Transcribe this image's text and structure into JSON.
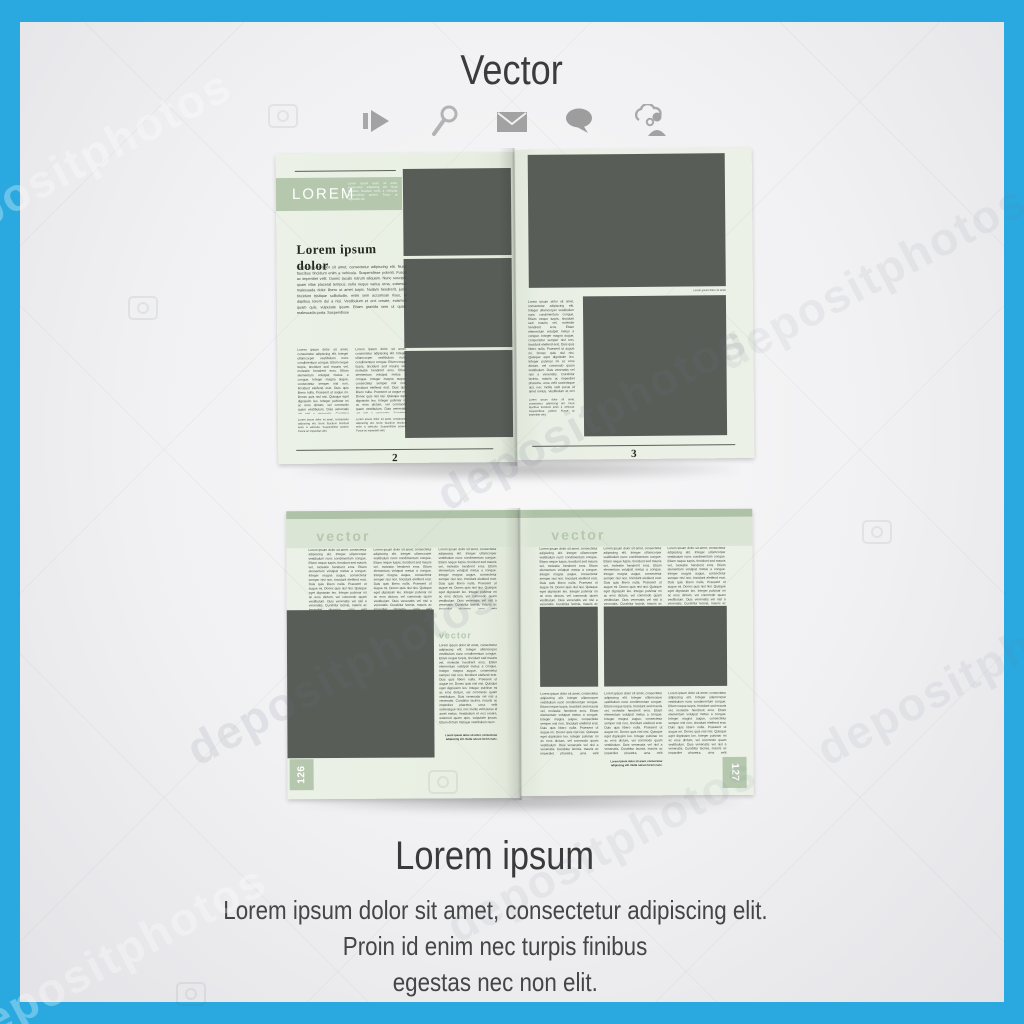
{
  "watermark": {
    "text": "depositphotos"
  },
  "header": {
    "title": "Vector",
    "icons": [
      "play-icon",
      "search-icon",
      "mail-icon",
      "chat-icon",
      "cloud-user-icon"
    ]
  },
  "lorem": {
    "body": "Lorem ipsum dolor sit amet, consectetur adipiscing elit. Integer ullamcorper vestibulum nunc condimentum congue. Etiam neque turpis, tincidunt sed mauris vel, molestie hendrerit eros. Etiam elementum volutpat metus a congue. Integer magna augue, consectetur semper nisl non, tincidunt eleifend erat. Duis quis libero nulla. Praesent ut augue mi. Donec quis nisl nisi. Quisque eget dignissim leo. Integer pulvinar mi ac eros dictum, vel commodo quam vestibulum. Duis venenatis vel nisl a venenatis. Curabitur lacinia, mauris ac imperdiet pharetra, urna velit scelerisque nisi, nec mollis velit purus id amet metus. Vestibulum et orci ornare, euismod quam quis, vulputate ipsum. Etiam dictum tristique vestibulum nunc.",
    "caption": "Lorem ipsum dolor sit amet, consectetur adipiscing elit. Nunc faucibus tincidunt enim a vehicula. Suspendisse potenti. Fusce ac imperdiet velit."
  },
  "magazine_top": {
    "left_page": {
      "banner_title": "LOREM",
      "banner_text": "Lorem ipsum dolor sit amet, consectetur adipiscing elit. Nunc faucibus tincidunt enim a vehicula. Suspendisse potenti. Fusce ac imperdiet elit.",
      "heading": "Lorem ipsum dolor",
      "intro": "Lorem ipsum dolor sit amet, consectetur adipiscing elit. Nunc faucibus tincidunt enim a vehicula. Suspendisse potenti. Fusce ac imperdiet velit. Donec iaculis rutrum aliquam. Nunc suscipit, quam vitae placerat tempus, nulla neque varius urna, euismod malesuada dolor libero ut amet turpis. Nullam hendrerit, justo tincidunt tristique sollicitudin, enim sem accumsan risus, id dapibus lorem dui a nisi. Vestibulum et orci ornare, euismod quam quis, vulputate ipsum. Etiam gravida sem ut quam malesuada porta. Suspendisse",
      "page_number": "2"
    },
    "right_page": {
      "photo_caption": "Lorem ipsum dolor sit amet",
      "page_number": "3"
    }
  },
  "magazine_bottom": {
    "logo": "vector",
    "left_page": {
      "page_number": "126",
      "bold_caption": "Lorem ipsum dolor sit amet, consectetur adipiscing elit. Nulla rutrum lorem nunc."
    },
    "right_page": {
      "page_number": "127",
      "bold_caption": "Lorem ipsum dolor sit amet, consectetur adipiscing elit. Nulla rutrum lorem nunc."
    }
  },
  "footer": {
    "heading": "Lorem ipsum",
    "line1": "Lorem ipsum dolor sit amet, consectetur adipiscing elit.",
    "line2": "Proin id enim nec turpis finibus",
    "line3": "egestas nec non elit."
  },
  "colors": {
    "frame_blue": "#2aa9e0",
    "page_green": "#e9efe4",
    "accent_green": "#b5c8ae",
    "band_light_green": "#dbe5d5",
    "band_dark_green": "#aec2a8",
    "photo_placeholder": "#585d58",
    "text_dark": "#3e433d"
  }
}
